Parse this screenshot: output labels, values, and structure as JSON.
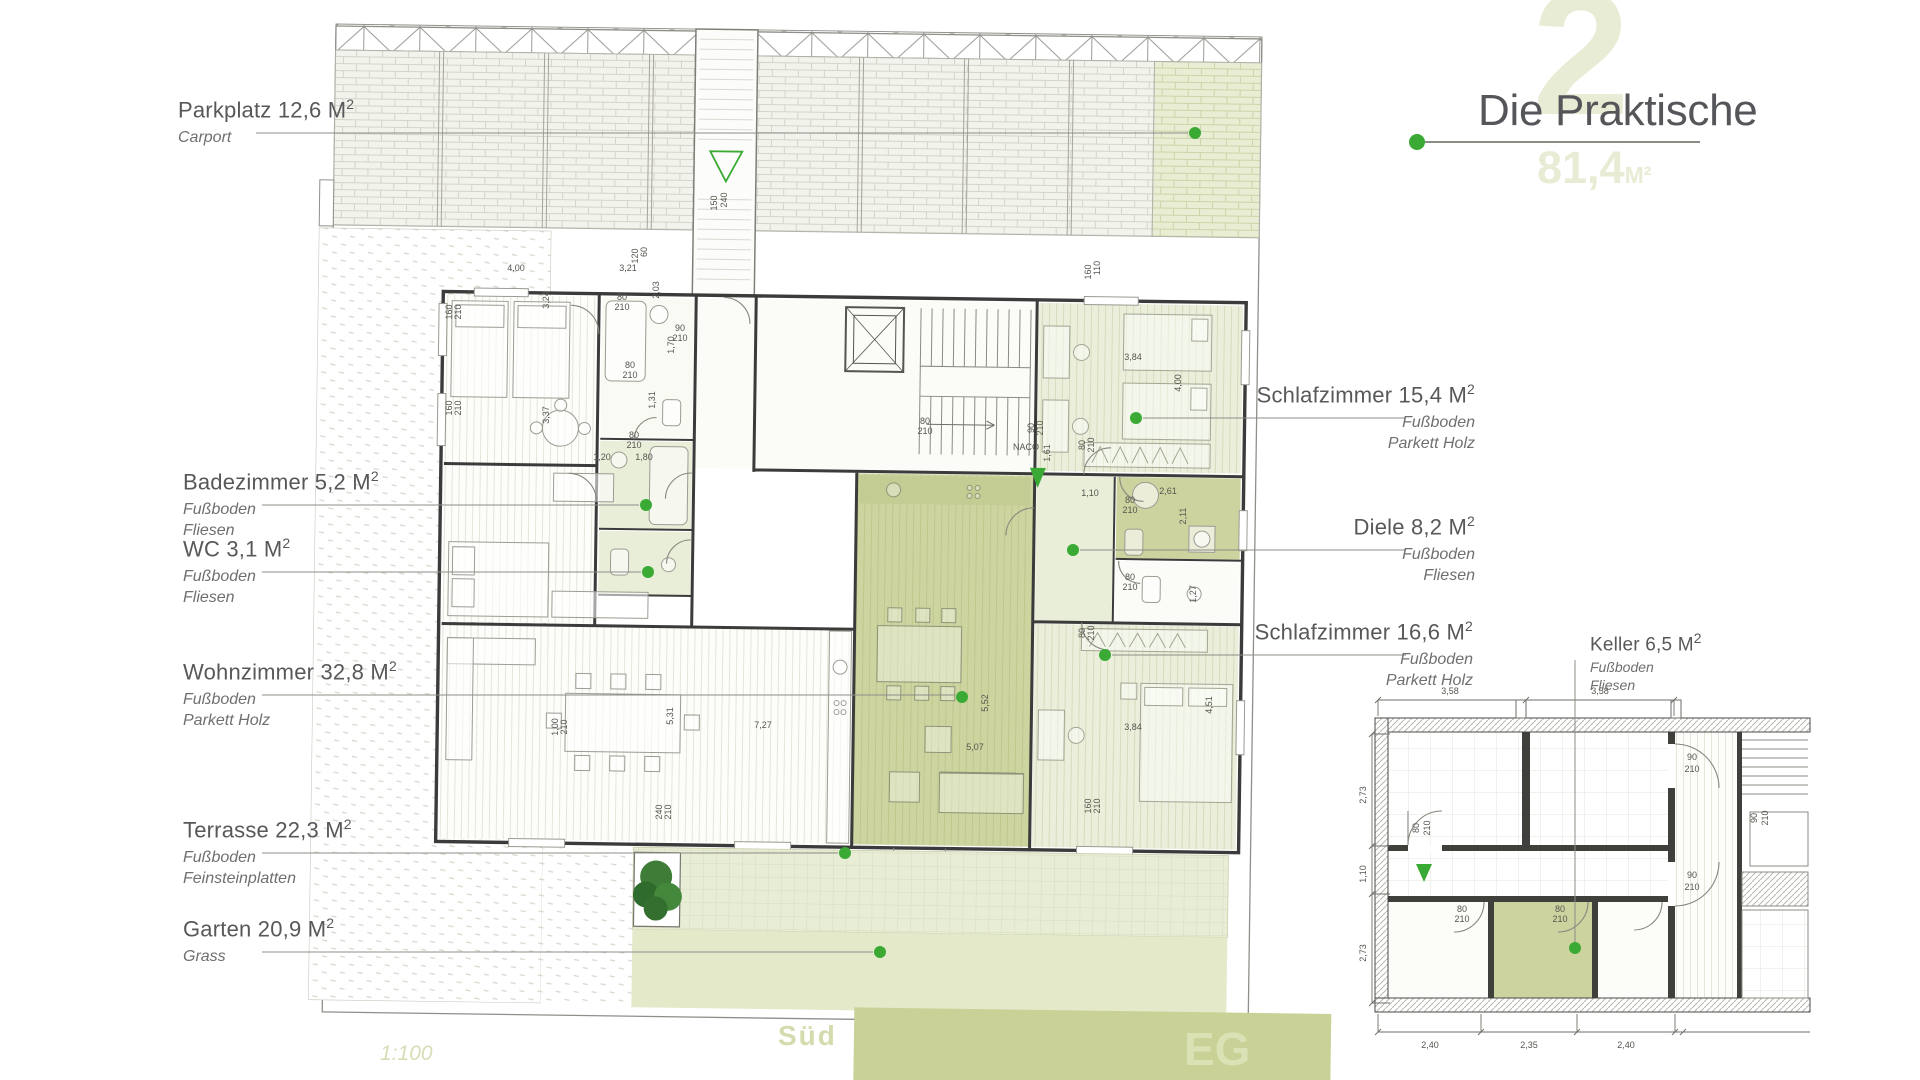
{
  "title_block": {
    "watermark": "2",
    "title": "Die Praktische",
    "area_value": "81,4",
    "area_unit": "M²"
  },
  "footer": {
    "scale": "1:100",
    "compass": "Süd",
    "floor": "EG"
  },
  "colors": {
    "accent_green": "#3aaa35",
    "pale_green": "#e9edd6",
    "olive": "#ccd39e",
    "watermark_green": "#e9ecd5",
    "label_gray": "#58585a"
  },
  "callouts": [
    {
      "name": "parkplatz",
      "title": "Parkplatz 12,6 M",
      "sup": "2",
      "lines": [
        "Carport"
      ],
      "align": "left",
      "tx": 178,
      "ty": 96,
      "leader": "h",
      "ly": 133,
      "lx1": 256,
      "lx2": 1188,
      "dot": [
        1195,
        133
      ]
    },
    {
      "name": "badezimmer",
      "title": "Badezimmer 5,2 M",
      "sup": "2",
      "lines": [
        "Fußboden",
        "Fliesen"
      ],
      "align": "left",
      "tx": 183,
      "ty": 468,
      "leader": "h",
      "ly": 505,
      "lx1": 262,
      "lx2": 639,
      "dot": [
        646,
        505
      ]
    },
    {
      "name": "wc",
      "title": "WC 3,1 M",
      "sup": "2",
      "lines": [
        "Fußboden",
        "Fliesen"
      ],
      "align": "left",
      "tx": 183,
      "ty": 535,
      "leader": "h",
      "ly": 572,
      "lx1": 262,
      "lx2": 641,
      "dot": [
        648,
        572
      ]
    },
    {
      "name": "wohnzimmer",
      "title": "Wohnzimmer 32,8 M",
      "sup": "2",
      "lines": [
        "Fußboden",
        "Parkett Holz"
      ],
      "align": "left",
      "tx": 183,
      "ty": 658,
      "leader": "h",
      "ly": 695,
      "lx1": 262,
      "lx2": 955,
      "dot": [
        962,
        697
      ]
    },
    {
      "name": "terrasse",
      "title": "Terrasse 22,3 M",
      "sup": "2",
      "lines": [
        "Fußboden",
        "Feinsteinplatten"
      ],
      "align": "left",
      "tx": 183,
      "ty": 816,
      "leader": "h",
      "ly": 853,
      "lx1": 262,
      "lx2": 838,
      "dot": [
        845,
        853
      ]
    },
    {
      "name": "garten",
      "title": "Garten 20,9 M",
      "sup": "2",
      "lines": [
        "Grass"
      ],
      "align": "left",
      "tx": 183,
      "ty": 915,
      "leader": "h",
      "ly": 952,
      "lx1": 262,
      "lx2": 873,
      "dot": [
        880,
        952
      ]
    },
    {
      "name": "schlafzimmer-15",
      "title": "Schlafzimmer 15,4 M",
      "sup": "2",
      "lines": [
        "Fußboden",
        "Parkett Holz"
      ],
      "align": "right",
      "tx": 1475,
      "ty": 381,
      "leader": "h",
      "ly": 418,
      "lx1": 1143,
      "lx2": 1406,
      "dot": [
        1136,
        418
      ]
    },
    {
      "name": "diele",
      "title": "Diele 8,2 M",
      "sup": "2",
      "lines": [
        "Fußboden",
        "Fliesen"
      ],
      "align": "right",
      "tx": 1475,
      "ty": 513,
      "leader": "h",
      "ly": 550,
      "lx1": 1080,
      "lx2": 1406,
      "dot": [
        1073,
        550
      ]
    },
    {
      "name": "schlafzimmer-16",
      "title": "Schlafzimmer 16,6 M",
      "sup": "2",
      "lines": [
        "Fußboden",
        "Parkett Holz"
      ],
      "align": "right",
      "tx": 1473,
      "ty": 618,
      "leader": "h",
      "ly": 655,
      "lx1": 1112,
      "lx2": 1406,
      "dot": [
        1105,
        655
      ]
    },
    {
      "name": "keller",
      "title": "Keller 6,5 M",
      "sup": "2",
      "lines": [
        "Fußboden",
        "Fliesen"
      ],
      "align": "left",
      "small": true,
      "tx": 1590,
      "ty": 630,
      "leader": "v",
      "lx": 1575,
      "ly1": 660,
      "ly2": 948,
      "dot": [
        1575,
        948
      ]
    }
  ],
  "plan": {
    "dimensions": [
      {
        "t": "4,00",
        "x": 516,
        "y": 271,
        "s": 10
      },
      {
        "t": "3,21",
        "x": 628,
        "y": 271,
        "s": 10
      },
      {
        "t": "3,24",
        "x": 549,
        "y": 300,
        "r": -90,
        "s": 10
      },
      {
        "t": "120",
        "x": 638,
        "y": 256,
        "r": -90
      },
      {
        "t": "60",
        "x": 647,
        "y": 252,
        "r": -90
      },
      {
        "t": "2,03",
        "x": 659,
        "y": 290,
        "r": -90
      },
      {
        "t": "160",
        "x": 452,
        "y": 312,
        "r": -90
      },
      {
        "t": "210",
        "x": 461,
        "y": 312,
        "r": -90
      },
      {
        "t": "160",
        "x": 452,
        "y": 408,
        "r": -90
      },
      {
        "t": "210",
        "x": 461,
        "y": 408,
        "r": -90
      },
      {
        "t": "80",
        "x": 622,
        "y": 300
      },
      {
        "t": "210",
        "x": 622,
        "y": 310
      },
      {
        "t": "90",
        "x": 680,
        "y": 331
      },
      {
        "t": "210",
        "x": 680,
        "y": 341
      },
      {
        "t": "1,70",
        "x": 674,
        "y": 345,
        "r": -90
      },
      {
        "t": "80",
        "x": 630,
        "y": 368
      },
      {
        "t": "210",
        "x": 630,
        "y": 378
      },
      {
        "t": "1,31",
        "x": 655,
        "y": 400,
        "r": -90
      },
      {
        "t": "3,37",
        "x": 549,
        "y": 415,
        "r": -90
      },
      {
        "t": "80",
        "x": 634,
        "y": 438
      },
      {
        "t": "210",
        "x": 634,
        "y": 448
      },
      {
        "t": "1,20",
        "x": 602,
        "y": 460
      },
      {
        "t": "1,80",
        "x": 644,
        "y": 460
      },
      {
        "t": "150",
        "x": 717,
        "y": 203,
        "r": -90
      },
      {
        "t": "240",
        "x": 727,
        "y": 200,
        "r": -90
      },
      {
        "t": "NACO",
        "x": 1026,
        "y": 450,
        "s": 6.5
      },
      {
        "t": "80",
        "x": 925,
        "y": 424
      },
      {
        "t": "210",
        "x": 925,
        "y": 434
      },
      {
        "t": "160",
        "x": 1091,
        "y": 272,
        "r": -90
      },
      {
        "t": "110",
        "x": 1100,
        "y": 268,
        "r": -90
      },
      {
        "t": "3,84",
        "x": 1133,
        "y": 360,
        "s": 10
      },
      {
        "t": "4,00",
        "x": 1181,
        "y": 383,
        "r": -90,
        "s": 10
      },
      {
        "t": "80",
        "x": 1085,
        "y": 445,
        "r": -90
      },
      {
        "t": "210",
        "x": 1094,
        "y": 445,
        "r": -90
      },
      {
        "t": "1,61",
        "x": 1050,
        "y": 453,
        "r": -90
      },
      {
        "t": "90",
        "x": 1034,
        "y": 428,
        "r": -90
      },
      {
        "t": "210",
        "x": 1043,
        "y": 428,
        "r": -90
      },
      {
        "t": "1,10",
        "x": 1090,
        "y": 496,
        "s": 10
      },
      {
        "t": "2,61",
        "x": 1168,
        "y": 494,
        "s": 10
      },
      {
        "t": "80",
        "x": 1130,
        "y": 503
      },
      {
        "t": "210",
        "x": 1130,
        "y": 513
      },
      {
        "t": "2,11",
        "x": 1186,
        "y": 516,
        "r": -90,
        "s": 10
      },
      {
        "t": "80",
        "x": 1130,
        "y": 580
      },
      {
        "t": "210",
        "x": 1130,
        "y": 590
      },
      {
        "t": "1,27",
        "x": 1196,
        "y": 594,
        "r": -90
      },
      {
        "t": "80",
        "x": 1085,
        "y": 633,
        "r": -90
      },
      {
        "t": "210",
        "x": 1094,
        "y": 633,
        "r": -90
      },
      {
        "t": "3,84",
        "x": 1133,
        "y": 730,
        "s": 10
      },
      {
        "t": "4,51",
        "x": 1212,
        "y": 705,
        "r": -90,
        "s": 10
      },
      {
        "t": "160",
        "x": 1091,
        "y": 806,
        "r": -90
      },
      {
        "t": "210",
        "x": 1100,
        "y": 806,
        "r": -90
      },
      {
        "t": "5,52",
        "x": 988,
        "y": 703,
        "r": -90,
        "s": 10
      },
      {
        "t": "5,07",
        "x": 975,
        "y": 750,
        "s": 10
      },
      {
        "t": "7,27",
        "x": 763,
        "y": 728,
        "s": 10
      },
      {
        "t": "5,31",
        "x": 673,
        "y": 716,
        "r": -90,
        "s": 10
      },
      {
        "t": "1,00",
        "x": 558,
        "y": 727,
        "r": -90
      },
      {
        "t": "210",
        "x": 567,
        "y": 727,
        "r": -90
      },
      {
        "t": "240",
        "x": 662,
        "y": 812,
        "r": -90
      },
      {
        "t": "210",
        "x": 671,
        "y": 812,
        "r": -90
      },
      {
        "t": "3,58",
        "x": 1450,
        "y": 694,
        "s": 11
      },
      {
        "t": "3,58",
        "x": 1600,
        "y": 694,
        "s": 11
      },
      {
        "t": "2,73",
        "x": 1366,
        "y": 795,
        "r": -90,
        "s": 11
      },
      {
        "t": "1,10",
        "x": 1366,
        "y": 874,
        "r": -90,
        "s": 11
      },
      {
        "t": "2,73",
        "x": 1366,
        "y": 953,
        "r": -90,
        "s": 11
      },
      {
        "t": "2,40",
        "x": 1430,
        "y": 1048,
        "s": 11
      },
      {
        "t": "2,35",
        "x": 1529,
        "y": 1048,
        "s": 11
      },
      {
        "t": "2,40",
        "x": 1626,
        "y": 1048,
        "s": 11
      },
      {
        "t": "90",
        "x": 1692,
        "y": 760
      },
      {
        "t": "210",
        "x": 1692,
        "y": 772
      },
      {
        "t": "90",
        "x": 1692,
        "y": 878
      },
      {
        "t": "210",
        "x": 1692,
        "y": 890
      },
      {
        "t": "80",
        "x": 1419,
        "y": 828,
        "r": -90
      },
      {
        "t": "210",
        "x": 1430,
        "y": 828,
        "r": -90
      },
      {
        "t": "80",
        "x": 1462,
        "y": 912
      },
      {
        "t": "210",
        "x": 1462,
        "y": 922
      },
      {
        "t": "80",
        "x": 1560,
        "y": 912
      },
      {
        "t": "210",
        "x": 1560,
        "y": 922
      },
      {
        "t": "90",
        "x": 1757,
        "y": 818,
        "r": -90
      },
      {
        "t": "210",
        "x": 1768,
        "y": 818,
        "r": -90
      }
    ]
  }
}
